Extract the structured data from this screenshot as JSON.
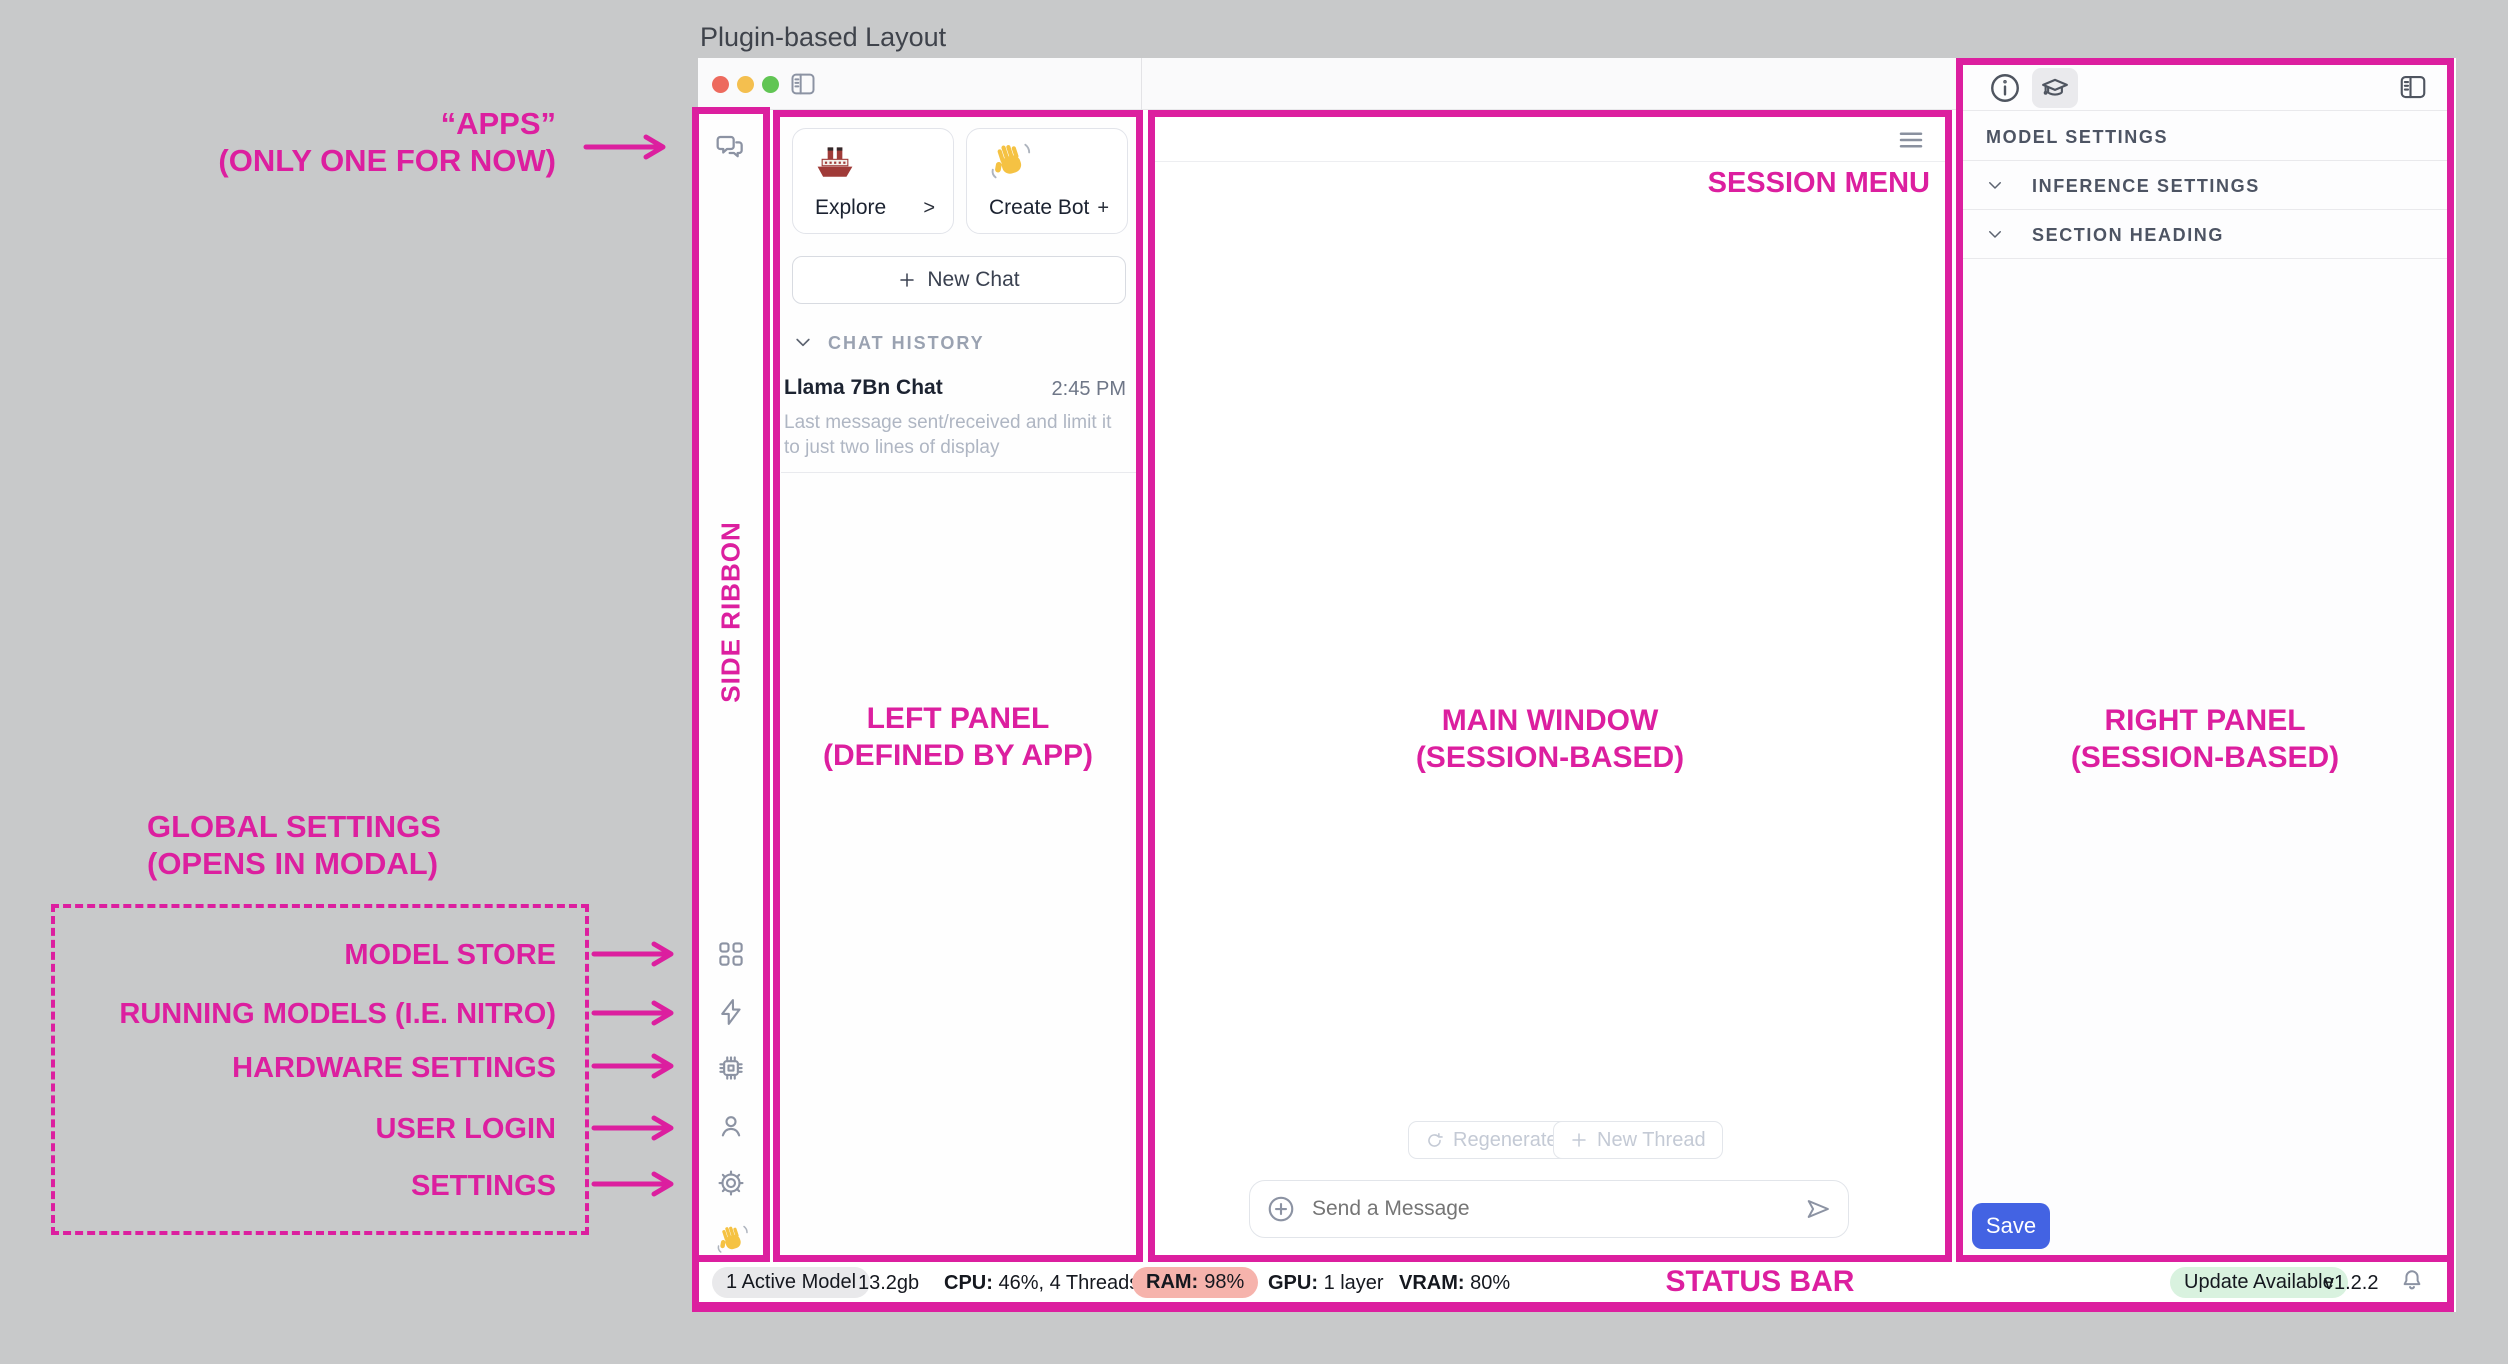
{
  "page_title": "Plugin-based Layout",
  "annotations": {
    "apps_line1": "“APPS”",
    "apps_line2": "(ONLY ONE FOR NOW)",
    "side_ribbon": "SIDE RIBBON",
    "left_panel_line1": "LEFT PANEL",
    "left_panel_line2": "(DEFINED BY APP)",
    "main_window_line1": "MAIN WINDOW",
    "main_window_line2": "(SESSION-BASED)",
    "session_menu": "SESSION MENU",
    "right_panel_line1": "RIGHT PANEL",
    "right_panel_line2": "(SESSION-BASED)",
    "status_bar": "STATUS BAR",
    "global_settings_line1": "GLOBAL SETTINGS",
    "global_settings_line2": "(OPENS IN MODAL)",
    "global_items": [
      "MODEL STORE",
      "RUNNING MODELS (I.E. NITRO)",
      "HARDWARE SETTINGS",
      "USER LOGIN",
      "SETTINGS"
    ]
  },
  "left_panel": {
    "explore_label": "Explore",
    "explore_affix": ">",
    "create_bot_label": "Create Bot",
    "create_bot_affix": "+",
    "new_chat_label": "New Chat",
    "history_header": "CHAT HISTORY",
    "chat_title": "Llama 7Bn Chat",
    "chat_time": "2:45 PM",
    "chat_preview": "Last message sent/received and limit it to just two lines of display"
  },
  "main": {
    "regenerate_label": "Regenerate",
    "new_thread_label": "New Thread",
    "composer_placeholder": "Send a Message"
  },
  "right_panel": {
    "header": "MODEL SETTINGS",
    "section_1": "INFERENCE SETTINGS",
    "section_2": "SECTION HEADING",
    "save_label": "Save"
  },
  "status_bar": {
    "active_model": "1 Active Model",
    "size": "13.2gb",
    "cpu_label": "CPU:",
    "cpu_value": "46%, 4 Threads",
    "ram_label": "RAM:",
    "ram_value": "98%",
    "gpu_label": "GPU:",
    "gpu_value": "1 layer",
    "vram_label": "VRAM:",
    "vram_value": "80%",
    "update": "Update Available",
    "version": "v1.2.2"
  },
  "icons": {
    "titlebar": [
      "traffic-red",
      "traffic-yellow",
      "traffic-green",
      "sidebar-toggle"
    ],
    "ribbon": [
      "chat-bubbles",
      "apps-grid",
      "bolt",
      "chip",
      "user",
      "gear",
      "wave-hand"
    ],
    "left_panel": [
      "ship-emoji",
      "wave-hand-emoji",
      "plus",
      "chevron-down"
    ],
    "main": [
      "hamburger-menu",
      "refresh",
      "plus",
      "plus-circle",
      "send"
    ],
    "right_panel": [
      "info-circle",
      "graduation-cap",
      "sidebar-toggle",
      "chevron-down"
    ],
    "status_bar": [
      "bell"
    ]
  },
  "colors": {
    "magenta": "#DC1F9F",
    "save_blue": "#4363E3",
    "ram_pill": "#F6B3AC",
    "update_pill": "#D9F2DF",
    "neutral_pill": "#E9E9EB",
    "traffic_red": "#ED6A5E",
    "traffic_yellow": "#F4BF4F",
    "traffic_green": "#61C554"
  }
}
